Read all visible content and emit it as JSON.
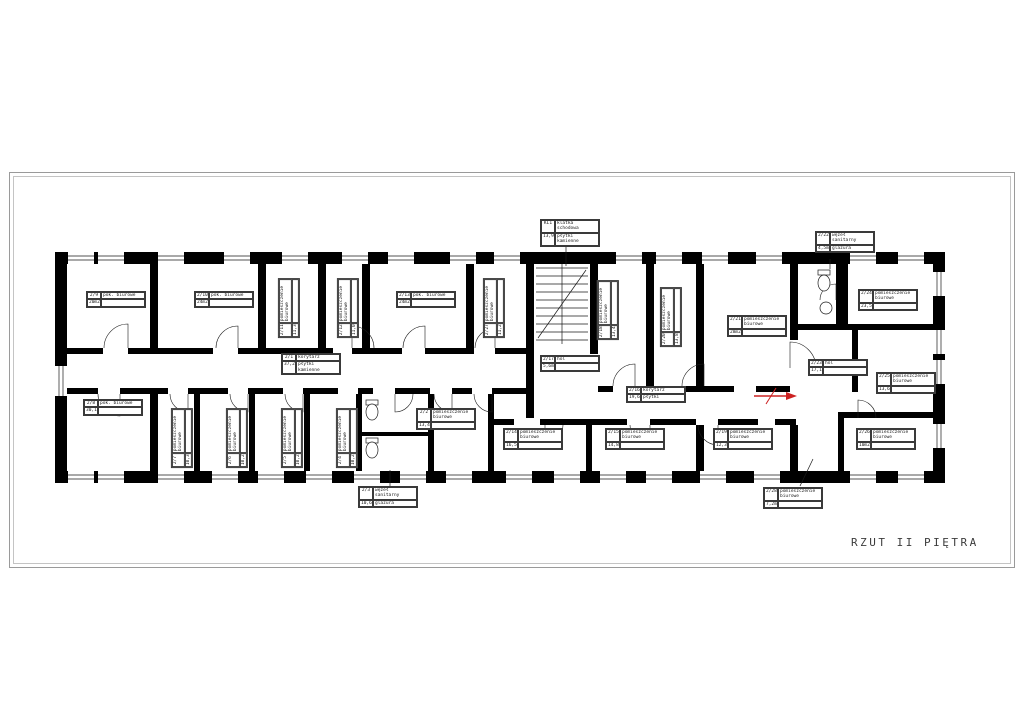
{
  "sheet": {
    "title": "RZUT II PIĘTRA"
  },
  "colors": {
    "walls": "#000000",
    "thin_lines": "#1a1a1a",
    "arrow": "#cc2222",
    "frame": "#9a9a9a",
    "paper": "#ffffff"
  },
  "rooms": [
    {
      "id": "2/1",
      "name": "korytarz",
      "area": "37,24m2",
      "finish": "płytki kamienne"
    },
    {
      "id": "2/2",
      "name": "pomieszczenie biurowe",
      "area": "13,4m2",
      "finish": ""
    },
    {
      "id": "2/3",
      "name": "węzeł sanitarny",
      "area": "10,64m2",
      "finish": "glazura"
    },
    {
      "id": "2/4",
      "name": "pomieszczenie biurowe",
      "area": "10,2m2",
      "finish": ""
    },
    {
      "id": "2/5",
      "name": "pomieszczenie biurowe",
      "area": "10,2m2",
      "finish": ""
    },
    {
      "id": "2/6",
      "name": "pomieszczenie biurowe",
      "area": "10,2m2",
      "finish": ""
    },
    {
      "id": "2/7",
      "name": "pomieszczenie biurowe",
      "area": "10,3m2",
      "finish": ""
    },
    {
      "id": "2/8",
      "name": "pok. biurowe",
      "area": "30,1m2",
      "finish": ""
    },
    {
      "id": "2/9",
      "name": "pok. biurowe",
      "area": "20m2",
      "finish": ""
    },
    {
      "id": "2/10",
      "name": "pok. biurowe",
      "area": "24m2",
      "finish": ""
    },
    {
      "id": "2/11",
      "name": "pomieszczenie biurowe",
      "area": "11,3m2",
      "finish": ""
    },
    {
      "id": "2/12",
      "name": "pomieszczenie biurowe",
      "area": "11,0m2",
      "finish": ""
    },
    {
      "id": "2/13",
      "name": "pok. biurowe",
      "area": "24m2",
      "finish": ""
    },
    {
      "id": "2/27",
      "name": "pomieszczenie biurowe",
      "area": "11,2m2",
      "finish": ""
    },
    {
      "id": "KL1",
      "name": "klatka schodowa",
      "area": "13,92m2",
      "finish": "płytki kamienne"
    },
    {
      "id": "2/18",
      "name": "pomieszczenie biurowe",
      "area": "13,4m2",
      "finish": ""
    },
    {
      "id": "2/16",
      "name": "korytarz",
      "area": "19,6m2",
      "finish": "płytki"
    },
    {
      "id": "2/17",
      "name": "hol",
      "area": "5,6m2",
      "finish": ""
    },
    {
      "id": "2/20",
      "name": "pomieszczenie biurowe",
      "area": "13,8m2",
      "finish": ""
    },
    {
      "id": "2/14",
      "name": "pomieszczenie biurowe",
      "area": "16,5m2",
      "finish": ""
    },
    {
      "id": "2/15",
      "name": "pomieszczenie biurowe",
      "area": "14,8m2",
      "finish": ""
    },
    {
      "id": "2/19",
      "name": "pomieszczenie biurowe",
      "area": "12,3m2",
      "finish": ""
    },
    {
      "id": "2/21",
      "name": "pomieszczenie biurowe",
      "area": "28m2",
      "finish": ""
    },
    {
      "id": "2/22",
      "name": "węzeł sanitarny",
      "area": "4,5m2",
      "finish": "glazura"
    },
    {
      "id": "2/23",
      "name": "hol",
      "area": "17,1m2",
      "finish": ""
    },
    {
      "id": "2/24",
      "name": "pomieszczenie biurowe",
      "area": "23,5m2",
      "finish": ""
    },
    {
      "id": "2/25",
      "name": "pomieszczenie biurowe",
      "area": "13,6m2",
      "finish": ""
    },
    {
      "id": "2/26",
      "name": "pomieszczenie biurowe",
      "area": "10m2",
      "finish": ""
    },
    {
      "id": "2/28",
      "name": "pomieszczenie biurowe",
      "area": "7,2m2",
      "finish": ""
    }
  ]
}
